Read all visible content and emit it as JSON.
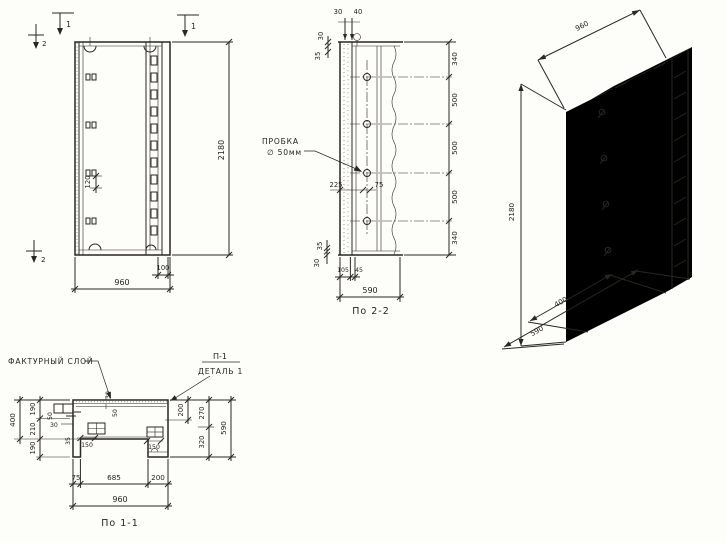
{
  "elevation": {
    "flag_cut1_left": "1",
    "flag_cut1_right": "1",
    "flag_cut2_top": "2",
    "flag_cut2_bottom": "2",
    "dim_height": "2180",
    "dim_width": "960",
    "dim_channel": "100",
    "dim_hook": "120"
  },
  "section22": {
    "caption": "По 2-2",
    "plug_label_1": "ПРОБКА",
    "plug_label_2": "∅ 50мм",
    "dim_top_a": "30",
    "dim_top_b": "40",
    "dim_left_a": "30",
    "dim_left_b": "35",
    "dim_right": [
      "340",
      "500",
      "500",
      "500",
      "340"
    ],
    "dim_mid_a": "225",
    "dim_mid_b": "75",
    "dim_bot_a": "35",
    "dim_bot_b": "30",
    "dim_bot_c": "105",
    "dim_bot_d": "45",
    "dim_width": "590"
  },
  "axon": {
    "dim_width": "960",
    "dim_height": "2180",
    "dim_depth_a": "400",
    "dim_depth_b": "590"
  },
  "section11": {
    "caption": "По 1-1",
    "label_facing": "ФАКТУРНЫЙ СЛОЙ",
    "label_detail_1": "П-1",
    "label_detail_2": "ДЕТАЛЬ 1",
    "dim_left_outer": "400",
    "dim_left": [
      "190",
      "210",
      "190"
    ],
    "dim_top_a": "50",
    "dim_top_b": "30",
    "dim_top_c": "50",
    "dim_mid_a": "30",
    "dim_mid_b": "35",
    "dim_mid_c": "150",
    "dim_mid_d": "150",
    "dim_right_a": "200",
    "dim_right_b": "270",
    "dim_right_c": "320",
    "dim_right_outer": "590",
    "dim_bot": [
      "75",
      "685",
      "200"
    ],
    "dim_bot_total": "960"
  }
}
